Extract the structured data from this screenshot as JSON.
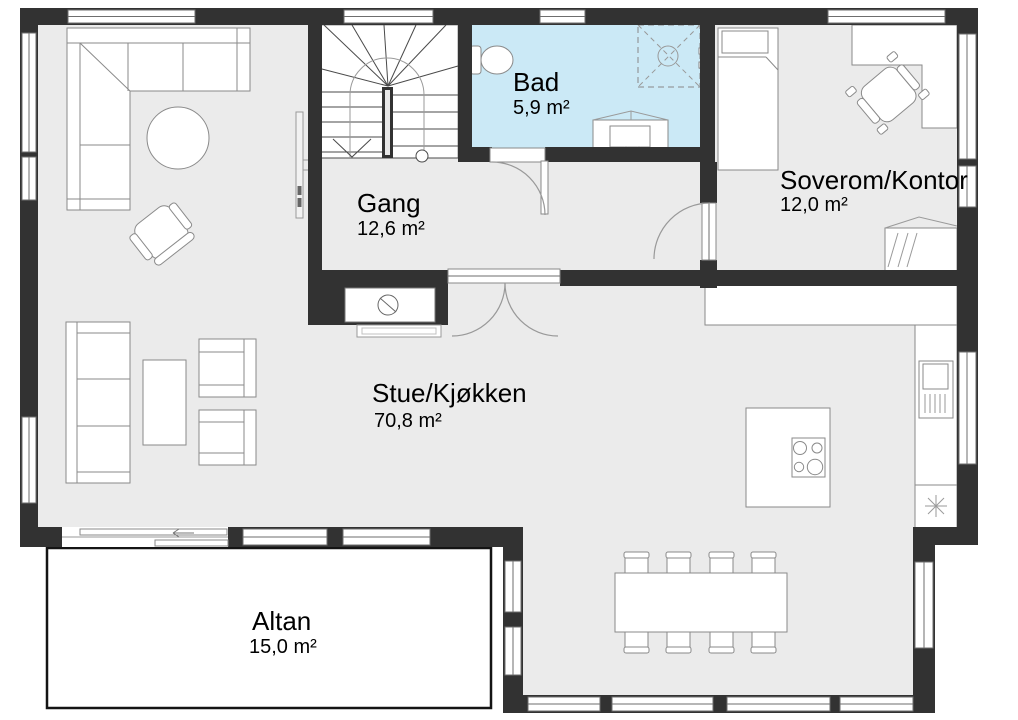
{
  "rooms": {
    "stue": {
      "name": "Stue/Kjøkken",
      "area": "70,8 m²"
    },
    "gang": {
      "name": "Gang",
      "area": "12,6 m²"
    },
    "bad": {
      "name": "Bad",
      "area": "5,9 m²"
    },
    "soverom": {
      "name": "Soverom/Kontor",
      "area": "12,0 m²"
    },
    "altan": {
      "name": "Altan",
      "area": "15,0 m²"
    }
  },
  "colors": {
    "wall": "#323232",
    "floor": "#ebebeb",
    "bathroom_floor": "#cbe9f6",
    "furniture_outline": "#8a8a8a",
    "balcony_outline": "#141414"
  }
}
